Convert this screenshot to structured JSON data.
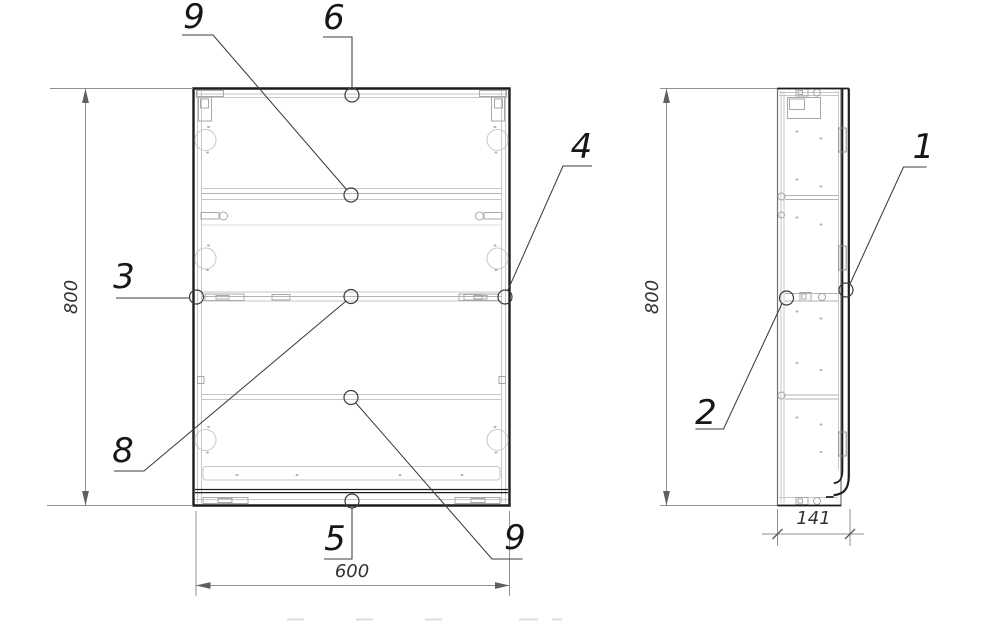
{
  "drawing": {
    "background": "#ffffff",
    "colors": {
      "outline": "#1d1d1d",
      "detail_line": "#c7c7c7",
      "dimension_line": "#919191",
      "leader_line": "#3c3c3c"
    },
    "views": {
      "front": {
        "dim_height": "800",
        "dim_width": "600",
        "callouts": {
          "shelf_top": "9",
          "top_panel": "6",
          "right_panel": "4",
          "left_panel": "3",
          "middle_shelf": "8",
          "bottom_panel": "5",
          "shelf_lower": "9"
        }
      },
      "side": {
        "dim_height": "800",
        "dim_depth": "141",
        "callouts": {
          "door": "1",
          "side_panel": "2"
        }
      }
    }
  }
}
